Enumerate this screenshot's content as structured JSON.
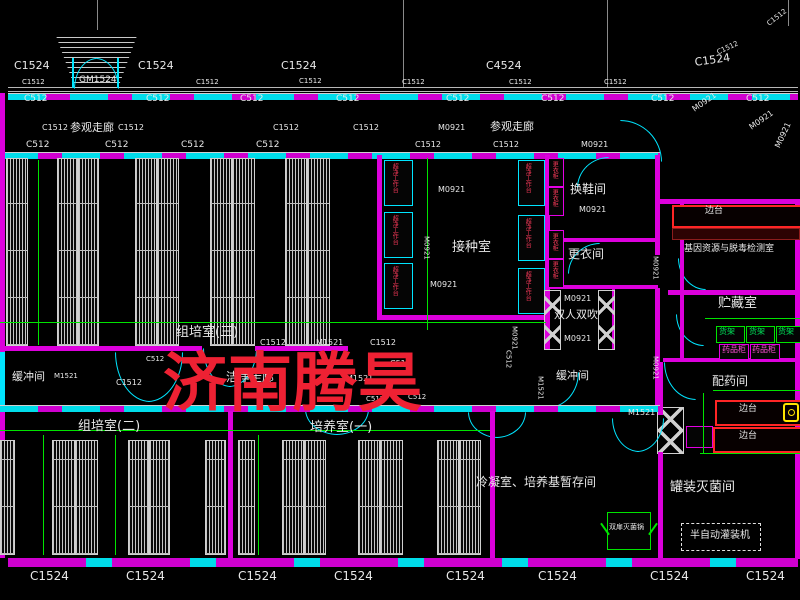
{
  "drawing": {
    "type": "CAD floor plan",
    "subject": "plant tissue culture laboratory layout"
  },
  "watermark": {
    "text": "济南腾昊",
    "color": "#ee2133"
  },
  "colors": {
    "background": "#000000",
    "wall_magenta": "#dc00dc",
    "window_cyan": "#00e5ff",
    "dimension_green": "#00e400",
    "text_white": "#e8e8e8",
    "equipment_red": "#ff3b5c",
    "shelf_green": "#00e45a",
    "cabinet_magenta": "#ff4fd8",
    "bench_red": "#ff2525",
    "watermark_red": "#ee2133"
  },
  "annotations": [
    {
      "name": "window-tag",
      "text": "C1524",
      "x": 14,
      "y": 60,
      "fs": 11
    },
    {
      "name": "window-tag",
      "text": "C1524",
      "x": 138,
      "y": 60,
      "fs": 11
    },
    {
      "name": "window-tag",
      "text": "C1524",
      "x": 281,
      "y": 60,
      "fs": 11
    },
    {
      "name": "window-tag",
      "text": "C4524",
      "x": 486,
      "y": 60,
      "fs": 11
    },
    {
      "name": "window-tag",
      "text": "C1524",
      "x": 694,
      "y": 57,
      "fs": 11,
      "rot": -8
    },
    {
      "name": "window-tag",
      "text": "C1512",
      "x": 716,
      "y": 50,
      "fs": 7,
      "rot": -25
    },
    {
      "name": "window-tag",
      "text": "C1512",
      "x": 766,
      "y": 22,
      "fs": 7,
      "rot": -38
    },
    {
      "name": "door-tag",
      "text": "GM1524",
      "x": 79,
      "y": 76,
      "fs": 9
    },
    {
      "name": "window-tag",
      "text": "C1512",
      "x": 22,
      "y": 79,
      "fs": 7
    },
    {
      "name": "window-tag",
      "text": "C1512",
      "x": 196,
      "y": 79,
      "fs": 7
    },
    {
      "name": "window-tag",
      "text": "C1512",
      "x": 299,
      "y": 78,
      "fs": 7
    },
    {
      "name": "window-tag",
      "text": "C1512",
      "x": 402,
      "y": 79,
      "fs": 7
    },
    {
      "name": "window-tag",
      "text": "C1512",
      "x": 509,
      "y": 79,
      "fs": 7
    },
    {
      "name": "window-tag",
      "text": "C1512",
      "x": 604,
      "y": 79,
      "fs": 7
    },
    {
      "name": "window-tag",
      "text": "C512",
      "x": 24,
      "y": 95,
      "fs": 9
    },
    {
      "name": "window-tag",
      "text": "C512",
      "x": 146,
      "y": 95,
      "fs": 9
    },
    {
      "name": "window-tag",
      "text": "C512",
      "x": 240,
      "y": 95,
      "fs": 9
    },
    {
      "name": "window-tag",
      "text": "C512",
      "x": 336,
      "y": 95,
      "fs": 9
    },
    {
      "name": "window-tag",
      "text": "C512",
      "x": 446,
      "y": 95,
      "fs": 9
    },
    {
      "name": "window-tag",
      "text": "C512",
      "x": 541,
      "y": 95,
      "fs": 9
    },
    {
      "name": "window-tag",
      "text": "C512",
      "x": 651,
      "y": 95,
      "fs": 9
    },
    {
      "name": "window-tag",
      "text": "C512",
      "x": 746,
      "y": 95,
      "fs": 9
    },
    {
      "name": "room-label",
      "text": "参观走廊",
      "x": 70,
      "y": 122,
      "fs": 11
    },
    {
      "name": "room-label",
      "text": "参观走廊",
      "x": 490,
      "y": 121,
      "fs": 11
    },
    {
      "name": "door-tag",
      "text": "M0921",
      "x": 438,
      "y": 124,
      "fs": 8
    },
    {
      "name": "door-tag",
      "text": "M0921",
      "x": 691,
      "y": 107,
      "fs": 8,
      "rot": -35
    },
    {
      "name": "door-tag",
      "text": "M0921",
      "x": 748,
      "y": 125,
      "fs": 8,
      "rot": -35
    },
    {
      "name": "door-tag",
      "text": "M0921",
      "x": 774,
      "y": 146,
      "fs": 8,
      "rot": -65
    },
    {
      "name": "window-tag",
      "text": "C1512",
      "x": 42,
      "y": 124,
      "fs": 8
    },
    {
      "name": "window-tag",
      "text": "C1512",
      "x": 118,
      "y": 124,
      "fs": 8
    },
    {
      "name": "window-tag",
      "text": "C1512",
      "x": 273,
      "y": 124,
      "fs": 8
    },
    {
      "name": "window-tag",
      "text": "C1512",
      "x": 353,
      "y": 124,
      "fs": 8
    },
    {
      "name": "window-tag",
      "text": "C512",
      "x": 26,
      "y": 141,
      "fs": 9
    },
    {
      "name": "window-tag",
      "text": "C512",
      "x": 105,
      "y": 141,
      "fs": 9
    },
    {
      "name": "window-tag",
      "text": "C512",
      "x": 181,
      "y": 141,
      "fs": 9
    },
    {
      "name": "window-tag",
      "text": "C512",
      "x": 256,
      "y": 141,
      "fs": 9
    },
    {
      "name": "window-tag",
      "text": "C1512",
      "x": 415,
      "y": 141,
      "fs": 8
    },
    {
      "name": "window-tag",
      "text": "C1512",
      "x": 493,
      "y": 141,
      "fs": 8
    },
    {
      "name": "door-tag",
      "text": "M0921",
      "x": 581,
      "y": 141,
      "fs": 8
    },
    {
      "name": "door-tag",
      "text": "M0921",
      "x": 438,
      "y": 186,
      "fs": 8
    },
    {
      "name": "room-label",
      "text": "接种室",
      "x": 452,
      "y": 241,
      "fs": 13
    },
    {
      "name": "door-tag",
      "text": "M0921",
      "x": 422,
      "y": 236,
      "fs": 7,
      "vert": true
    },
    {
      "name": "door-tag",
      "text": "M0921",
      "x": 430,
      "y": 281,
      "fs": 8
    },
    {
      "name": "room-label",
      "text": "换鞋间",
      "x": 570,
      "y": 183,
      "fs": 12
    },
    {
      "name": "door-tag",
      "text": "M0921",
      "x": 579,
      "y": 206,
      "fs": 8
    },
    {
      "name": "room-label",
      "text": "更衣间",
      "x": 568,
      "y": 248,
      "fs": 12
    },
    {
      "name": "room-label",
      "text": "双人双吹",
      "x": 554,
      "y": 309,
      "fs": 11
    },
    {
      "name": "door-tag",
      "text": "M0921",
      "x": 564,
      "y": 295,
      "fs": 8
    },
    {
      "name": "door-tag",
      "text": "M0921",
      "x": 564,
      "y": 335,
      "fs": 8
    },
    {
      "name": "room-label",
      "text": "组培室(三)",
      "x": 176,
      "y": 326,
      "fs": 13
    },
    {
      "name": "equipment-label",
      "text": "超净工作台",
      "x": 391,
      "y": 163,
      "fs": 6,
      "color": "#ff3b5c",
      "vert": true
    },
    {
      "name": "equipment-label",
      "text": "超净工作台",
      "x": 391,
      "y": 215,
      "fs": 6,
      "color": "#ff3b5c",
      "vert": true
    },
    {
      "name": "equipment-label",
      "text": "超净工作台",
      "x": 391,
      "y": 266,
      "fs": 6,
      "color": "#ff3b5c",
      "vert": true
    },
    {
      "name": "equipment-label",
      "text": "超净工作台",
      "x": 524,
      "y": 163,
      "fs": 6,
      "color": "#ff3b5c",
      "vert": true
    },
    {
      "name": "equipment-label",
      "text": "超净工作台",
      "x": 524,
      "y": 218,
      "fs": 6,
      "color": "#ff3b5c",
      "vert": true
    },
    {
      "name": "equipment-label",
      "text": "超净工作台",
      "x": 524,
      "y": 271,
      "fs": 6,
      "color": "#ff3b5c",
      "vert": true
    },
    {
      "name": "equipment-label",
      "text": "更衣柜",
      "x": 551,
      "y": 161,
      "fs": 6,
      "color": "#ff3b5c",
      "vert": true
    },
    {
      "name": "equipment-label",
      "text": "更衣柜",
      "x": 551,
      "y": 189,
      "fs": 6,
      "color": "#ff3b5c",
      "vert": true
    },
    {
      "name": "equipment-label",
      "text": "更衣柜",
      "x": 551,
      "y": 233,
      "fs": 6,
      "color": "#ff3b5c",
      "vert": true
    },
    {
      "name": "equipment-label",
      "text": "更衣柜",
      "x": 551,
      "y": 261,
      "fs": 6,
      "color": "#ff3b5c",
      "vert": true
    },
    {
      "name": "equipment-label",
      "text": "边台",
      "x": 705,
      "y": 207,
      "fs": 9
    },
    {
      "name": "room-label",
      "text": "基因资源与脱毒检测室",
      "x": 684,
      "y": 245,
      "fs": 9
    },
    {
      "name": "room-label",
      "text": "贮藏室",
      "x": 718,
      "y": 297,
      "fs": 13
    },
    {
      "name": "equipment-label",
      "text": "货架",
      "x": 719,
      "y": 328,
      "fs": 8,
      "color": "#00e45a"
    },
    {
      "name": "equipment-label",
      "text": "货架",
      "x": 749,
      "y": 328,
      "fs": 8,
      "color": "#00e45a"
    },
    {
      "name": "equipment-label",
      "text": "货架",
      "x": 778,
      "y": 328,
      "fs": 8,
      "color": "#00e45a"
    },
    {
      "name": "equipment-label",
      "text": "药品柜",
      "x": 722,
      "y": 346,
      "fs": 8,
      "color": "#ff4fd8"
    },
    {
      "name": "equipment-label",
      "text": "药品柜",
      "x": 752,
      "y": 346,
      "fs": 8,
      "color": "#ff4fd8"
    },
    {
      "name": "room-label",
      "text": "配药间",
      "x": 712,
      "y": 375,
      "fs": 12
    },
    {
      "name": "equipment-label",
      "text": "边台",
      "x": 739,
      "y": 405,
      "fs": 9
    },
    {
      "name": "equipment-label",
      "text": "边台",
      "x": 739,
      "y": 432,
      "fs": 9
    },
    {
      "name": "door-tag",
      "text": "M0921",
      "x": 651,
      "y": 256,
      "fs": 7,
      "vert": true
    },
    {
      "name": "door-tag",
      "text": "M0921",
      "x": 651,
      "y": 356,
      "fs": 7,
      "vert": true
    },
    {
      "name": "room-label",
      "text": "罐装灭菌间",
      "x": 670,
      "y": 481,
      "fs": 13
    },
    {
      "name": "equipment-label",
      "text": "半自动灌装机",
      "x": 690,
      "y": 531,
      "fs": 10
    },
    {
      "name": "equipment-label",
      "text": "双扉灭菌锅",
      "x": 609,
      "y": 524,
      "fs": 7
    },
    {
      "name": "room-label",
      "text": "缓冲间",
      "x": 12,
      "y": 371,
      "fs": 11
    },
    {
      "name": "door-tag",
      "text": "M1521",
      "x": 54,
      "y": 373,
      "fs": 7
    },
    {
      "name": "window-tag",
      "text": "C1512",
      "x": 116,
      "y": 379,
      "fs": 8
    },
    {
      "name": "window-tag",
      "text": "C512",
      "x": 146,
      "y": 356,
      "fs": 7
    },
    {
      "name": "room-label",
      "text": "洁净走廊",
      "x": 226,
      "y": 371,
      "fs": 12
    },
    {
      "name": "window-tag",
      "text": "C1512",
      "x": 260,
      "y": 339,
      "fs": 8
    },
    {
      "name": "door-tag",
      "text": "M1521",
      "x": 316,
      "y": 339,
      "fs": 8
    },
    {
      "name": "window-tag",
      "text": "C1512",
      "x": 370,
      "y": 339,
      "fs": 8
    },
    {
      "name": "door-tag",
      "text": "M1521",
      "x": 346,
      "y": 375,
      "fs": 8
    },
    {
      "name": "window-tag",
      "text": "C512",
      "x": 390,
      "y": 360,
      "fs": 8
    },
    {
      "name": "window-tag",
      "text": "C512",
      "x": 504,
      "y": 350,
      "fs": 7,
      "vert": true
    },
    {
      "name": "door-tag",
      "text": "M0921",
      "x": 510,
      "y": 326,
      "fs": 7,
      "vert": true
    },
    {
      "name": "room-label",
      "text": "缓冲间",
      "x": 556,
      "y": 370,
      "fs": 11
    },
    {
      "name": "door-tag",
      "text": "M1521",
      "x": 536,
      "y": 376,
      "fs": 7,
      "vert": true
    },
    {
      "name": "door-tag",
      "text": "M1521",
      "x": 628,
      "y": 409,
      "fs": 8
    },
    {
      "name": "window-tag",
      "text": "C512",
      "x": 366,
      "y": 396,
      "fs": 7
    },
    {
      "name": "window-tag",
      "text": "C512",
      "x": 408,
      "y": 394,
      "fs": 7
    },
    {
      "name": "room-label",
      "text": "组培室(二)",
      "x": 78,
      "y": 420,
      "fs": 13
    },
    {
      "name": "room-label",
      "text": "培养室(一)",
      "x": 310,
      "y": 421,
      "fs": 13
    },
    {
      "name": "room-label",
      "text": "冷凝室、培养基暂存间",
      "x": 476,
      "y": 476,
      "fs": 12
    },
    {
      "name": "window-tag",
      "text": "C1524",
      "x": 30,
      "y": 570,
      "fs": 12
    },
    {
      "name": "window-tag",
      "text": "C1524",
      "x": 126,
      "y": 570,
      "fs": 12
    },
    {
      "name": "window-tag",
      "text": "C1524",
      "x": 238,
      "y": 570,
      "fs": 12
    },
    {
      "name": "window-tag",
      "text": "C1524",
      "x": 334,
      "y": 570,
      "fs": 12
    },
    {
      "name": "window-tag",
      "text": "C1524",
      "x": 446,
      "y": 570,
      "fs": 12
    },
    {
      "name": "window-tag",
      "text": "C1524",
      "x": 538,
      "y": 570,
      "fs": 12
    },
    {
      "name": "window-tag",
      "text": "C1524",
      "x": 650,
      "y": 570,
      "fs": 12
    },
    {
      "name": "window-tag",
      "text": "C1524",
      "x": 746,
      "y": 570,
      "fs": 12
    }
  ]
}
